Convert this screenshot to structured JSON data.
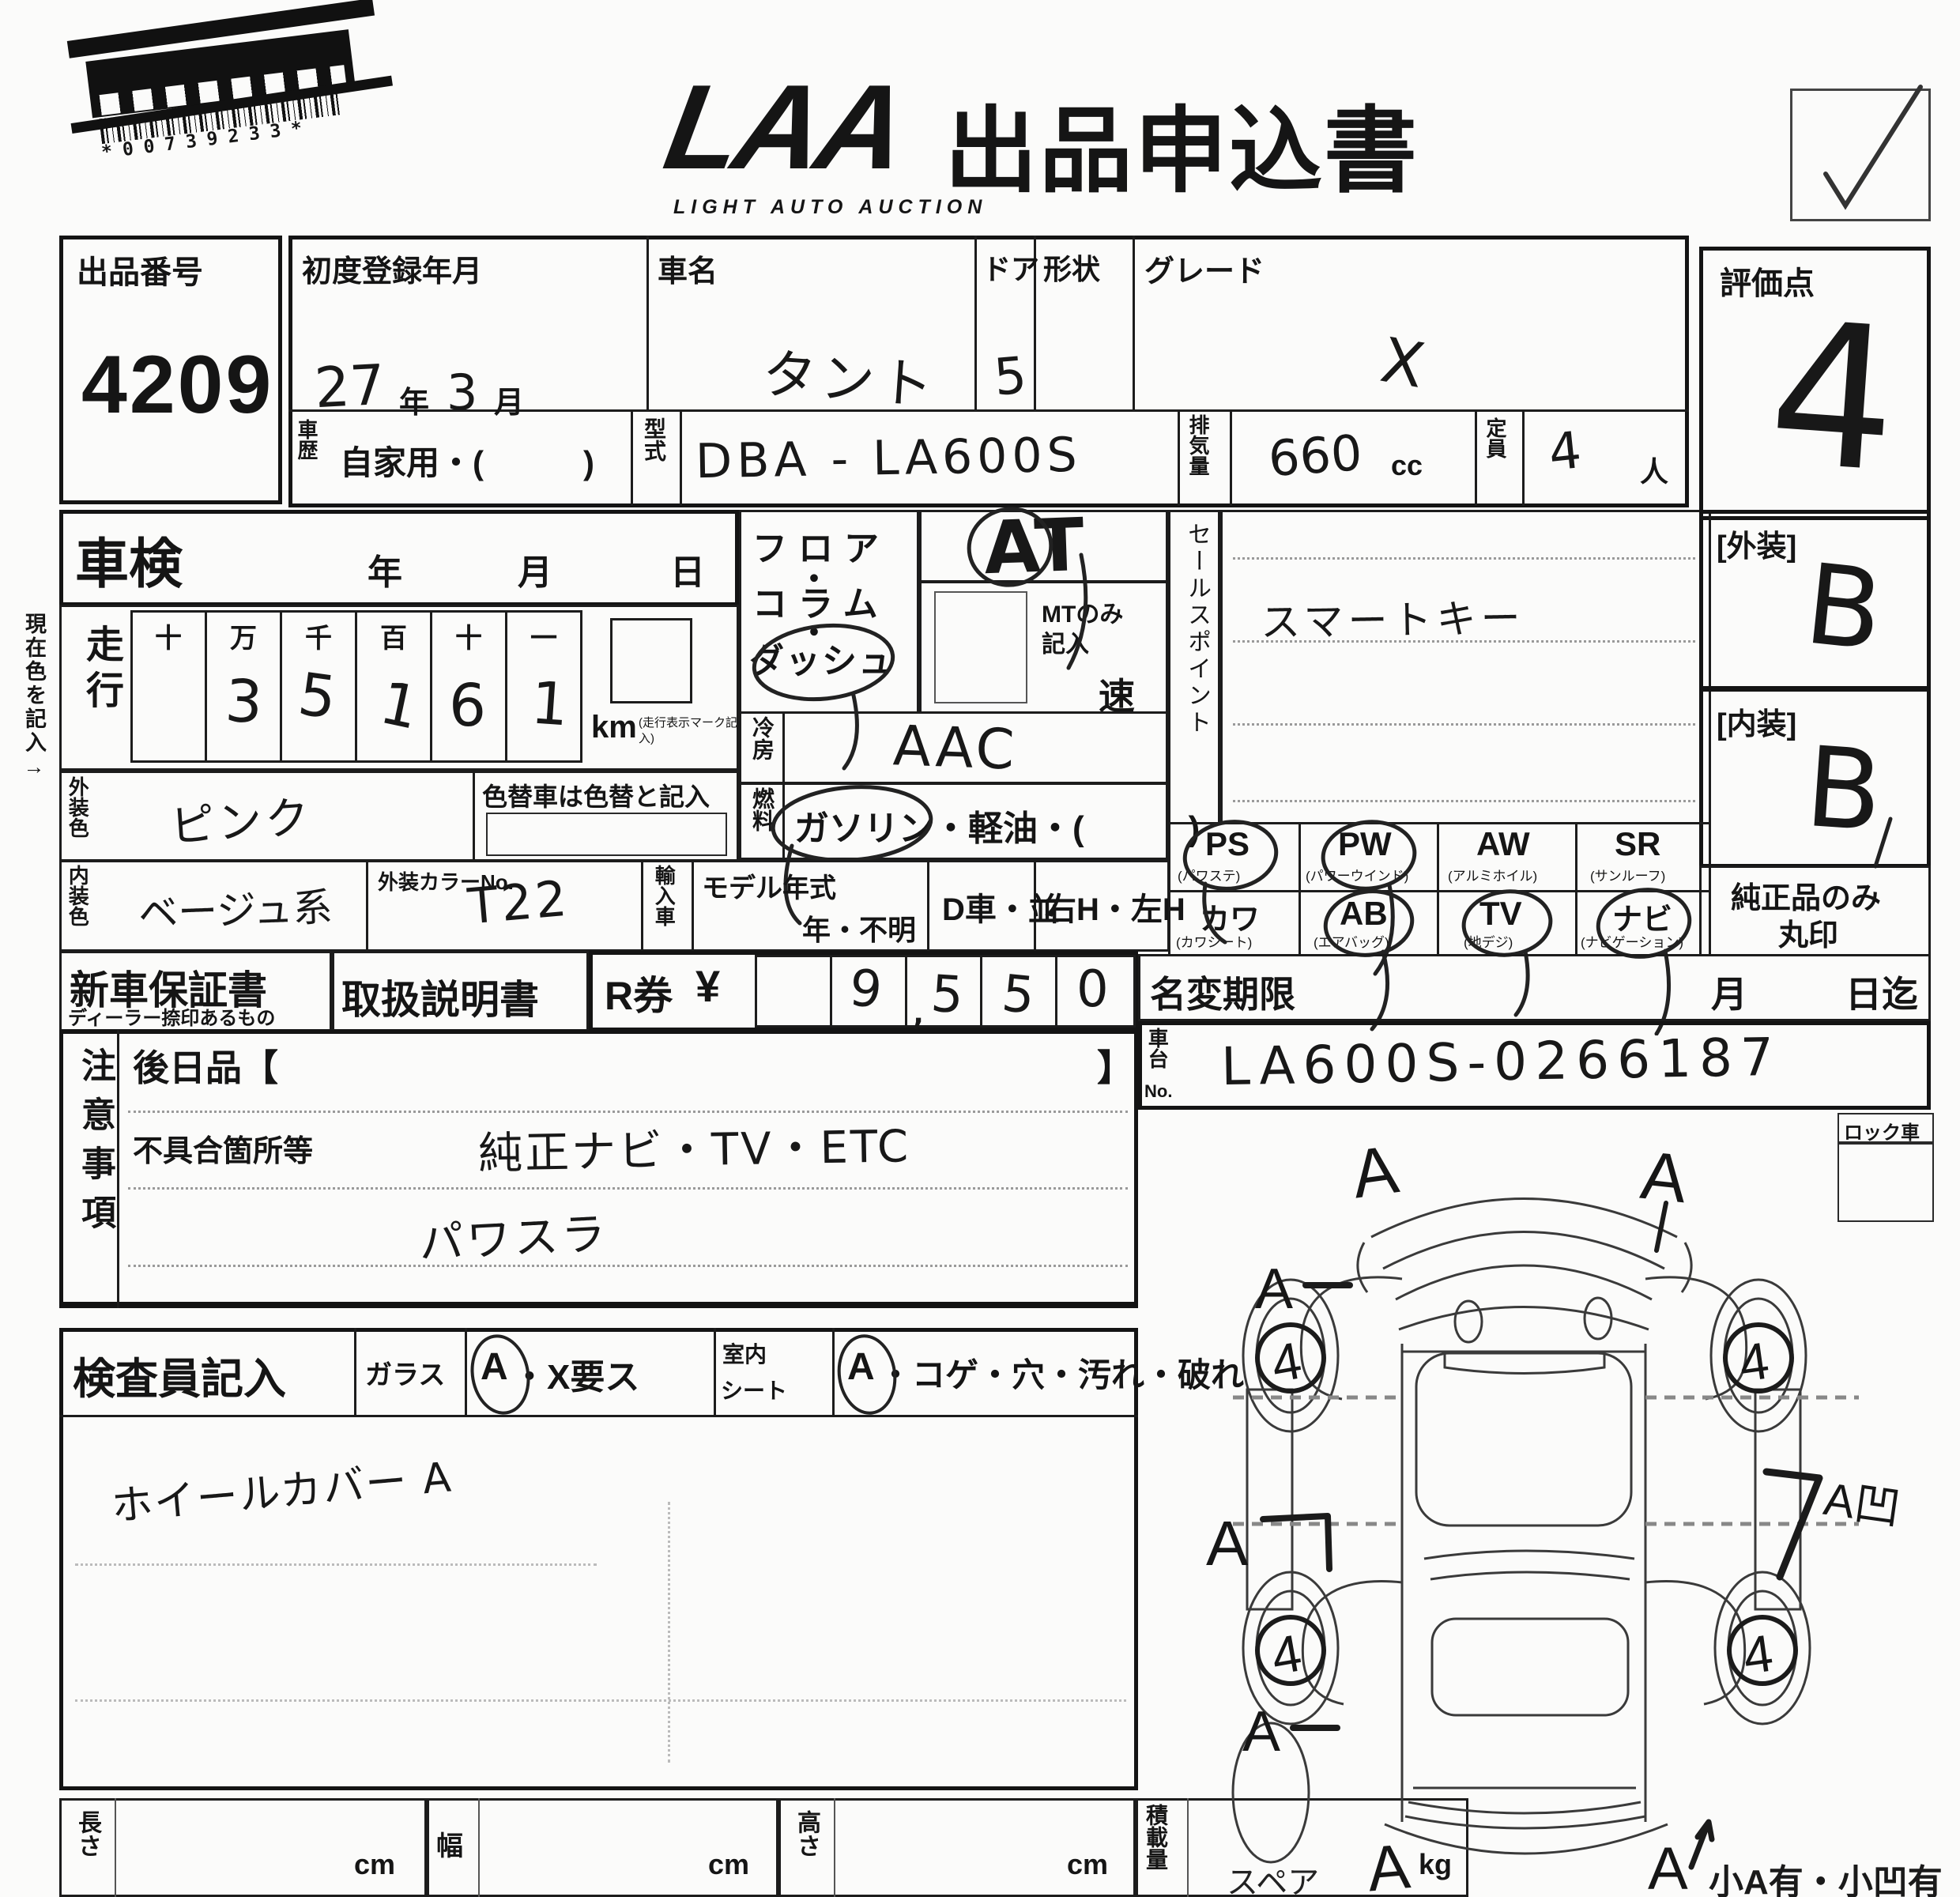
{
  "header": {
    "barcode_number": "*00739233*",
    "logo": "LAA",
    "logo_sub": "LIGHT AUTO AUCTION",
    "title": "出品申込書"
  },
  "row1": {
    "auction_no_label": "出品番号",
    "auction_no": "4209",
    "first_reg_label": "初度登録年月",
    "first_reg_year": "27",
    "year_suffix": "年",
    "first_reg_month": "3",
    "month_suffix": "月",
    "car_name_label": "車名",
    "car_name": "タント",
    "door_label": "ドア",
    "door": "5",
    "shape_label": "形状",
    "grade_label": "グレード",
    "grade": "X",
    "score_label": "評価点",
    "score": "4"
  },
  "row2": {
    "history_label": "車歴",
    "history_value": "自家用・(　　　)",
    "model_code_label": "型式",
    "model_code": "DBA - LA600S",
    "disp_label": "排気量",
    "disp_value": "660",
    "disp_unit": "cc",
    "cap_label": "定員",
    "cap_value": "4",
    "cap_unit": "人"
  },
  "shaken": {
    "label": "車検",
    "y": "年",
    "m": "月",
    "d": "日"
  },
  "mileage": {
    "label": "走行",
    "cols": [
      "十",
      "万",
      "千",
      "百",
      "十",
      "一"
    ],
    "digits": [
      "",
      "3",
      "5",
      "1",
      "6",
      "1"
    ],
    "unit": "km",
    "unit_note": "(走行表示マーク記入)"
  },
  "trans": {
    "line1": "フロア",
    "dot1": "・",
    "line2": "コラム",
    "dot2": "・",
    "line3": "ダッシュ",
    "value": "AT",
    "mt_note1": "MTのみ",
    "mt_note2": "記入",
    "speed": "速"
  },
  "aircon": {
    "label": "冷房",
    "value": "AAC"
  },
  "fuel": {
    "label": "燃料",
    "value": "ガソリン・軽油・(　　　)"
  },
  "sales": {
    "label": "セールスポイント",
    "value": "スマートキー"
  },
  "grades": {
    "ext_label": "[外装]",
    "ext": "B",
    "int_label": "[内装]",
    "int": "B"
  },
  "colors": {
    "ext_label": "外装色",
    "ext": "ピンク",
    "change_note": "色替車は色替と記入",
    "int_label": "内装色",
    "int": "ベージュ系",
    "no_label": "外装カラーNo.",
    "no": "T22"
  },
  "middle": {
    "import": "輸入車",
    "my_label": "モデル年式",
    "my_value": "年・不明",
    "d_car": "D車・並",
    "handle": "右H・左H"
  },
  "equipment": {
    "items": [
      {
        "code": "PS",
        "name": "(パワステ)"
      },
      {
        "code": "PW",
        "name": "(パワーウインド)"
      },
      {
        "code": "AW",
        "name": "(アルミホイル)"
      },
      {
        "code": "SR",
        "name": "(サンルーフ)"
      },
      {
        "code": "カワ",
        "name": "(カワシート)"
      },
      {
        "code": "AB",
        "name": "(エアバッグ)"
      },
      {
        "code": "TV",
        "name": "(地デジ)"
      },
      {
        "code": "ナビ",
        "name": "(ナビゲーション)"
      }
    ],
    "genuine1": "純正品のみ",
    "genuine2": "丸印"
  },
  "docs": {
    "warranty": "新車保証書",
    "warranty_sub": "ディーラー捺印あるもの",
    "manual": "取扱説明書",
    "rticket": "R券",
    "yen": "¥",
    "digits": [
      "",
      "9",
      "5",
      "5",
      "0"
    ],
    "comma": ","
  },
  "namechange": {
    "label": "名変期限",
    "month": "月",
    "until": "日迄"
  },
  "chassis": {
    "l12": "車台",
    "l3": "No.",
    "value": "LA600S-0266187"
  },
  "notes": {
    "label": "注意事項",
    "later": "後日品【",
    "later_close": "】",
    "defect": "不具合箇所等",
    "hw1": "純正ナビ・TV・ETC",
    "hw2": "パワスラ"
  },
  "inspector": {
    "label": "検査員記入",
    "glass": "ガラス",
    "glass_a": "A",
    "glass_rest": "・X要ス",
    "seat1": "室内",
    "seat2": "シート",
    "seat_a": "A",
    "seat_rest": "・コゲ・穴・汚れ・破れ",
    "note": "ホイールカバー A"
  },
  "diagram": {
    "lock": "ロック車",
    "spare": "スペア",
    "bottom_note": "小A有・小凹有",
    "mark_a": "A",
    "wheel_grade": "4",
    "mark_dent": "A凹"
  },
  "dims": {
    "length": "長さ",
    "width": "幅",
    "height": "高さ",
    "load": "積載量",
    "cm": "cm",
    "kg": "kg"
  },
  "side_note": "現在色を記入→"
}
